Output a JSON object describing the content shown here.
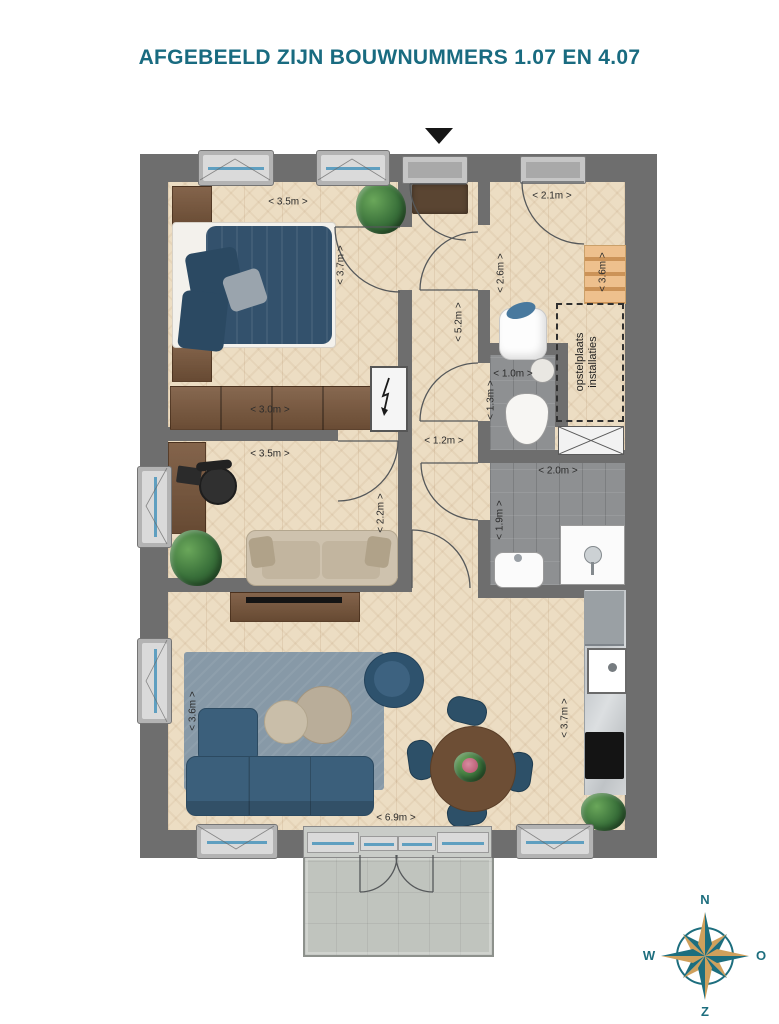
{
  "title": "AFGEBEELD ZIJN BOUWNUMMERS 1.07 EN 4.07",
  "plan": {
    "dimensions": {
      "bedroom_width": "< 3.5m >",
      "bedroom_depth": "< 3.7m >",
      "wardrobe_width": "< 3.0m >",
      "entry_hall_width": "< 2.1m >",
      "entry_hall_depth": "< 2.6m >",
      "stairs_length": "< 3.6m >",
      "hallway_length": "< 5.2m >",
      "toilet_width": "< 1.0m >",
      "toilet_depth": "< 1.3m >",
      "hallway_width": "< 1.2m >",
      "study_width": "< 3.5m >",
      "study_depth": "< 2.2m >",
      "bathroom_width": "< 2.0m >",
      "bathroom_depth": "< 1.9m >",
      "living_room_depth": "< 3.6m >",
      "living_room_width": "< 6.9m >",
      "kitchen_length": "< 3.7m >"
    },
    "annotations": {
      "technical_area_line1": "opstelplaats",
      "technical_area_line2": "installaties"
    }
  },
  "compass": {
    "north": "N",
    "east": "O",
    "south": "Z",
    "west": "W"
  },
  "colors": {
    "accent": "#196b80",
    "wall": "#6e6e6e",
    "parquet": "#ecddc3",
    "tile": "#8e9092",
    "terrace": "#c0c4be",
    "sofa_blue": "#3b5f7b",
    "wood": "#79573c",
    "stairs": "#eec08d",
    "rug": "#8799a7",
    "glass": "#5f9fc0",
    "compass_teal": "#1d6e7e",
    "compass_gold": "#cfa05c"
  }
}
